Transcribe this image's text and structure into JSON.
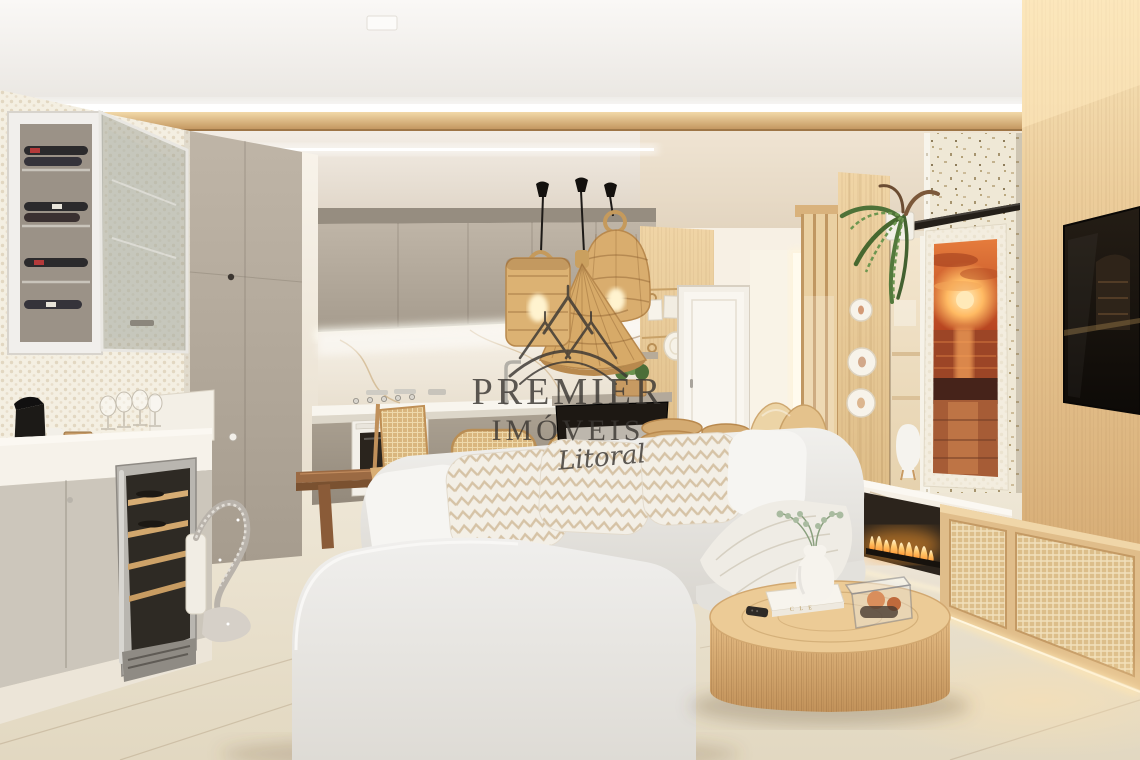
{
  "watermark": {
    "line1": "PREMIER",
    "line2": "IMÓVEIS",
    "line3": "Litoral",
    "color": "#3b3733"
  },
  "coffee_table": {
    "book_spine": "C L E"
  },
  "palette": {
    "ceiling_white": "#f7f5f2",
    "wood_trim": "#d8ae7c",
    "oak_wall": "#e9cb9c",
    "cabinet_taupe": "#b3a99b",
    "marble": "#f3eee5",
    "floor_cream": "#ebe3d2",
    "sofa_fabric": "#e9e7e3",
    "rattan": "#d4a96c",
    "fire_orange": "#ff9d2e",
    "sunset_art": "#c84a22",
    "fern_green": "#54783e",
    "watermark_gray": "#3b3733"
  }
}
